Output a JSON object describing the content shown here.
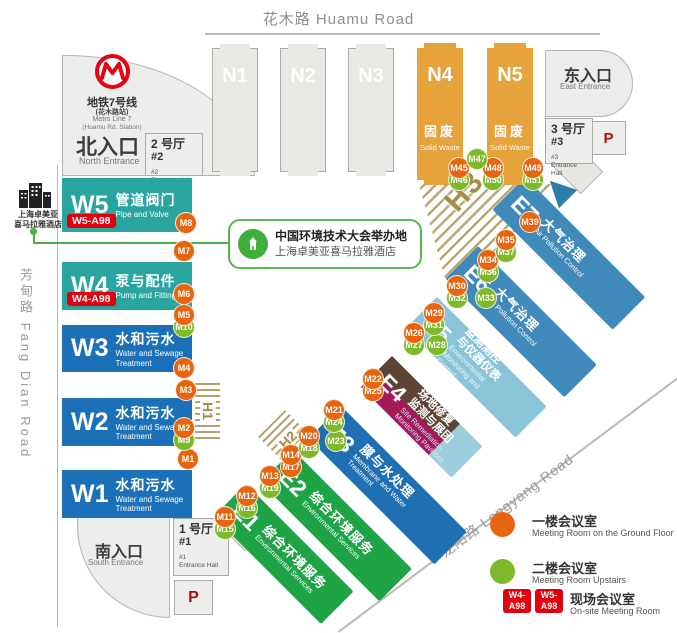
{
  "roads": {
    "top": {
      "zh": "花木路",
      "en": "Huamu Road"
    },
    "left": {
      "zh": "芳甸路",
      "en": "Fang Dian Road"
    },
    "longyang": {
      "zh": "龙阳路",
      "en": "Longyang Road"
    }
  },
  "metro": {
    "zh": "地铁7号线",
    "zh_sub": "(花木路站)",
    "en": "Metro Line 7",
    "en_sub": "(Huamu Rd. Station)"
  },
  "entrances": {
    "north": {
      "zh": "北入口",
      "en": "North Entrance"
    },
    "east": {
      "zh": "东入口",
      "en": "East Entrance"
    },
    "south": {
      "zh": "南入口",
      "en": "South Entrance"
    }
  },
  "entrance_halls": {
    "hall1": {
      "zh": "1 号厅",
      "num": "#1",
      "tiny1": "#1",
      "tiny2": "Entrance Hall"
    },
    "hall2": {
      "zh": "2 号厅",
      "num": "#2",
      "tiny1": "#2",
      "tiny2": "Entrance Hall"
    },
    "hall3": {
      "zh": "3 号厅",
      "num": "#3",
      "tiny1": "#3",
      "tiny2": "Entrance Hall"
    }
  },
  "parking_label": "P",
  "halls_n": [
    {
      "id": "N1"
    },
    {
      "id": "N2"
    },
    {
      "id": "N3"
    },
    {
      "id": "N4",
      "zh": "固废",
      "en": "Solid Waste"
    },
    {
      "id": "N5",
      "zh": "固废",
      "en": "Solid Waste"
    }
  ],
  "halls_w": [
    {
      "id": "W5",
      "zh": "管道阀门",
      "en": "Pipe and Valve",
      "badge": "W5-A98"
    },
    {
      "id": "W4",
      "zh": "泵与配件",
      "en": "Pump and Fittings",
      "badge": "W4-A98"
    },
    {
      "id": "W3",
      "zh": "水和污水",
      "en": "Water and Sewage Treatment"
    },
    {
      "id": "W2",
      "zh": "水和污水",
      "en": "Water and Sewage Treatment"
    },
    {
      "id": "W1",
      "zh": "水和污水",
      "en": "Water and Sewage Treatment"
    }
  ],
  "halls_e": [
    {
      "id": "E1",
      "zh": "综合环境服务",
      "en": "Environmental Services"
    },
    {
      "id": "E2",
      "zh": "综合环境服务",
      "en": "Environmental Services"
    },
    {
      "id": "E3",
      "zh": "膜与水处理",
      "en": "Membrane and Water Treatment"
    },
    {
      "id": "E4",
      "zh1": "场地修复",
      "zh2": "监测与展团",
      "en": "Site Remediation Monitoring Pavilions"
    },
    {
      "id": "E5",
      "zh1": "监测测控",
      "zh2": "与仪器仪表",
      "en": "Environmental Monitoring and Control"
    },
    {
      "id": "E6",
      "zh": "大气治理",
      "en": "Air Pollution Control"
    },
    {
      "id": "E7",
      "zh": "大气治理",
      "en": "Air Pollution Control"
    }
  ],
  "hatch": {
    "h1": "H1",
    "h2": "H2",
    "h3": "H3"
  },
  "hotel": {
    "l1": "上海卓美亚",
    "l2": "喜马拉雅酒店"
  },
  "callout": {
    "l1": "中国环境技术大会举办地",
    "l2": "上海卓美亚喜马拉雅酒店"
  },
  "legend": {
    "ground": {
      "zh": "一楼会议室",
      "en": "Meeting Room on the Ground Floor"
    },
    "upstairs": {
      "zh": "二楼会议室",
      "en": "Meeting Room Upstairs"
    },
    "onsite": {
      "zh": "现场会议室",
      "en": "On-site Meeting Room",
      "badge1_l1": "W4-",
      "badge1_l2": "A98",
      "badge2_l1": "W5-",
      "badge2_l2": "A98"
    }
  },
  "colors": {
    "ground_marker": "#E8650F",
    "upstairs_marker": "#7DB928",
    "onsite_badge": "#E2000F",
    "teal": "#2AA49E",
    "blue": "#1C70B7",
    "green": "#1FA347",
    "steel": "#4089BB",
    "lightblue": "#8AC4D8",
    "orange": "#E6A33B",
    "crimson": "#A5195B",
    "brown": "#5E4435",
    "hatch": "#B0965A",
    "metro_red": "#E60012"
  },
  "markers": [
    {
      "id": "M1",
      "x": 188,
      "y": 459,
      "type": "ground"
    },
    {
      "id": "M2",
      "x": 184,
      "y": 428,
      "type": "ground"
    },
    {
      "id": "M3",
      "x": 186,
      "y": 390,
      "type": "ground"
    },
    {
      "id": "M4",
      "x": 184,
      "y": 368,
      "type": "ground"
    },
    {
      "id": "M5",
      "x": 184,
      "y": 315,
      "type": "ground"
    },
    {
      "id": "M6",
      "x": 184,
      "y": 294,
      "type": "ground"
    },
    {
      "id": "M7",
      "x": 184,
      "y": 251,
      "type": "ground"
    },
    {
      "id": "M8",
      "x": 186,
      "y": 223,
      "type": "ground"
    },
    {
      "id": "M9",
      "x": 184,
      "y": 440,
      "type": "upstairs"
    },
    {
      "id": "M10",
      "x": 184,
      "y": 327,
      "type": "upstairs"
    },
    {
      "id": "M11",
      "x": 225,
      "y": 517,
      "type": "ground"
    },
    {
      "id": "M12",
      "x": 247,
      "y": 496,
      "type": "ground"
    },
    {
      "id": "M13",
      "x": 270,
      "y": 476,
      "type": "ground"
    },
    {
      "id": "M14",
      "x": 291,
      "y": 455,
      "type": "ground"
    },
    {
      "id": "M15",
      "x": 225,
      "y": 529,
      "type": "upstairs"
    },
    {
      "id": "M16",
      "x": 247,
      "y": 508,
      "type": "upstairs"
    },
    {
      "id": "M17",
      "x": 291,
      "y": 467,
      "type": "ground"
    },
    {
      "id": "M18",
      "x": 309,
      "y": 448,
      "type": "upstairs"
    },
    {
      "id": "M19",
      "x": 270,
      "y": 488,
      "type": "upstairs"
    },
    {
      "id": "M20",
      "x": 309,
      "y": 436,
      "type": "ground"
    },
    {
      "id": "M21",
      "x": 334,
      "y": 410,
      "type": "ground"
    },
    {
      "id": "M22",
      "x": 373,
      "y": 379,
      "type": "ground"
    },
    {
      "id": "M23",
      "x": 336,
      "y": 441,
      "type": "upstairs"
    },
    {
      "id": "M24",
      "x": 334,
      "y": 422,
      "type": "upstairs"
    },
    {
      "id": "M25",
      "x": 373,
      "y": 391,
      "type": "ground"
    },
    {
      "id": "M26",
      "x": 414,
      "y": 333,
      "type": "ground"
    },
    {
      "id": "M27",
      "x": 414,
      "y": 345,
      "type": "upstairs"
    },
    {
      "id": "M28",
      "x": 437,
      "y": 345,
      "type": "upstairs"
    },
    {
      "id": "M29",
      "x": 434,
      "y": 313,
      "type": "ground"
    },
    {
      "id": "M30",
      "x": 457,
      "y": 286,
      "type": "ground"
    },
    {
      "id": "M31",
      "x": 434,
      "y": 325,
      "type": "upstairs"
    },
    {
      "id": "M32",
      "x": 457,
      "y": 298,
      "type": "upstairs"
    },
    {
      "id": "M33",
      "x": 486,
      "y": 298,
      "type": "upstairs"
    },
    {
      "id": "M34",
      "x": 488,
      "y": 260,
      "type": "ground"
    },
    {
      "id": "M35",
      "x": 506,
      "y": 240,
      "type": "ground"
    },
    {
      "id": "M36",
      "x": 488,
      "y": 272,
      "type": "upstairs"
    },
    {
      "id": "M37",
      "x": 506,
      "y": 252,
      "type": "upstairs"
    },
    {
      "id": "M39",
      "x": 530,
      "y": 222,
      "type": "ground"
    },
    {
      "id": "M45",
      "x": 459,
      "y": 168,
      "type": "ground"
    },
    {
      "id": "M46",
      "x": 459,
      "y": 180,
      "type": "upstairs"
    },
    {
      "id": "M47",
      "x": 477,
      "y": 159,
      "type": "upstairs"
    },
    {
      "id": "M48",
      "x": 493,
      "y": 168,
      "type": "ground"
    },
    {
      "id": "M49",
      "x": 533,
      "y": 168,
      "type": "ground"
    },
    {
      "id": "M50",
      "x": 493,
      "y": 180,
      "type": "upstairs"
    },
    {
      "id": "M51",
      "x": 533,
      "y": 180,
      "type": "upstairs"
    }
  ]
}
